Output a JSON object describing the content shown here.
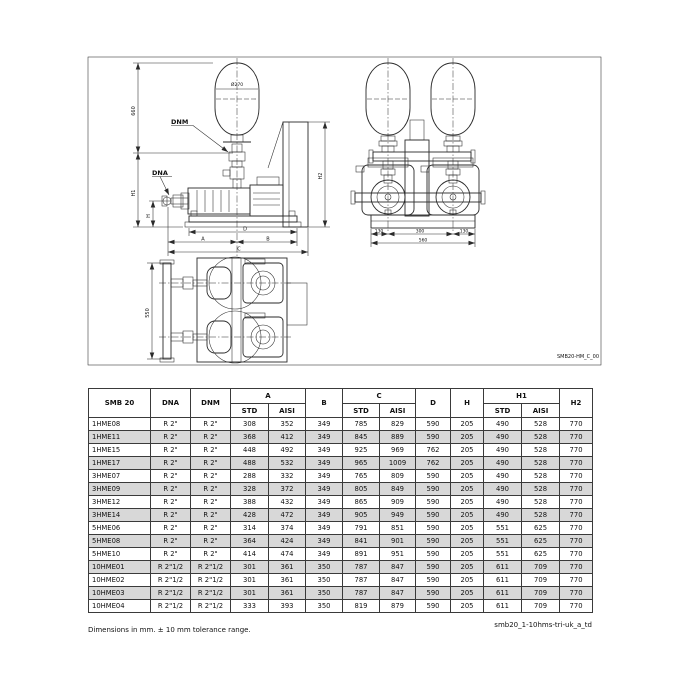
{
  "drawing": {
    "code": "SMB20-HM_C_00",
    "labels": {
      "dnm": "DNM",
      "dna": "DNA",
      "diam": "Ø270",
      "v660": "660",
      "h1": "H1",
      "h": "H",
      "h2": "H2",
      "d": "D",
      "a": "A",
      "b": "B",
      "c": "C",
      "f1": "130",
      "f2": "300",
      "f3": "130",
      "ftot": "560",
      "depth": "550"
    }
  },
  "table": {
    "headers": {
      "model": "SMB 20",
      "dna": "DNA",
      "dnm": "DNM",
      "a": "A",
      "b": "B",
      "c": "C",
      "d": "D",
      "h": "H",
      "h1": "H1",
      "h2": "H2",
      "std": "STD",
      "aisi": "AISI"
    },
    "rows": [
      {
        "m": "1HME08",
        "dna": "R 2\"",
        "dnm": "R 2\"",
        "a1": "308",
        "a2": "352",
        "b": "349",
        "c1": "785",
        "c2": "829",
        "d": "590",
        "h": "205",
        "h11": "490",
        "h12": "528",
        "h2": "770"
      },
      {
        "m": "1HME11",
        "dna": "R 2\"",
        "dnm": "R 2\"",
        "a1": "368",
        "a2": "412",
        "b": "349",
        "c1": "845",
        "c2": "889",
        "d": "590",
        "h": "205",
        "h11": "490",
        "h12": "528",
        "h2": "770"
      },
      {
        "m": "1HME15",
        "dna": "R 2\"",
        "dnm": "R 2\"",
        "a1": "448",
        "a2": "492",
        "b": "349",
        "c1": "925",
        "c2": "969",
        "d": "762",
        "h": "205",
        "h11": "490",
        "h12": "528",
        "h2": "770"
      },
      {
        "m": "1HME17",
        "dna": "R 2\"",
        "dnm": "R 2\"",
        "a1": "488",
        "a2": "532",
        "b": "349",
        "c1": "965",
        "c2": "1009",
        "d": "762",
        "h": "205",
        "h11": "490",
        "h12": "528",
        "h2": "770"
      },
      {
        "m": "3HME07",
        "dna": "R 2\"",
        "dnm": "R 2\"",
        "a1": "288",
        "a2": "332",
        "b": "349",
        "c1": "765",
        "c2": "809",
        "d": "590",
        "h": "205",
        "h11": "490",
        "h12": "528",
        "h2": "770"
      },
      {
        "m": "3HME09",
        "dna": "R 2\"",
        "dnm": "R 2\"",
        "a1": "328",
        "a2": "372",
        "b": "349",
        "c1": "805",
        "c2": "849",
        "d": "590",
        "h": "205",
        "h11": "490",
        "h12": "528",
        "h2": "770"
      },
      {
        "m": "3HME12",
        "dna": "R 2\"",
        "dnm": "R 2\"",
        "a1": "388",
        "a2": "432",
        "b": "349",
        "c1": "865",
        "c2": "909",
        "d": "590",
        "h": "205",
        "h11": "490",
        "h12": "528",
        "h2": "770"
      },
      {
        "m": "3HME14",
        "dna": "R 2\"",
        "dnm": "R 2\"",
        "a1": "428",
        "a2": "472",
        "b": "349",
        "c1": "905",
        "c2": "949",
        "d": "590",
        "h": "205",
        "h11": "490",
        "h12": "528",
        "h2": "770"
      },
      {
        "m": "5HME06",
        "dna": "R 2\"",
        "dnm": "R 2\"",
        "a1": "314",
        "a2": "374",
        "b": "349",
        "c1": "791",
        "c2": "851",
        "d": "590",
        "h": "205",
        "h11": "551",
        "h12": "625",
        "h2": "770"
      },
      {
        "m": "5HME08",
        "dna": "R 2\"",
        "dnm": "R 2\"",
        "a1": "364",
        "a2": "424",
        "b": "349",
        "c1": "841",
        "c2": "901",
        "d": "590",
        "h": "205",
        "h11": "551",
        "h12": "625",
        "h2": "770"
      },
      {
        "m": "5HME10",
        "dna": "R 2\"",
        "dnm": "R 2\"",
        "a1": "414",
        "a2": "474",
        "b": "349",
        "c1": "891",
        "c2": "951",
        "d": "590",
        "h": "205",
        "h11": "551",
        "h12": "625",
        "h2": "770"
      },
      {
        "m": "10HME01",
        "dna": "R 2\"1/2",
        "dnm": "R 2\"1/2",
        "a1": "301",
        "a2": "361",
        "b": "350",
        "c1": "787",
        "c2": "847",
        "d": "590",
        "h": "205",
        "h11": "611",
        "h12": "709",
        "h2": "770"
      },
      {
        "m": "10HME02",
        "dna": "R 2\"1/2",
        "dnm": "R 2\"1/2",
        "a1": "301",
        "a2": "361",
        "b": "350",
        "c1": "787",
        "c2": "847",
        "d": "590",
        "h": "205",
        "h11": "611",
        "h12": "709",
        "h2": "770"
      },
      {
        "m": "10HME03",
        "dna": "R 2\"1/2",
        "dnm": "R 2\"1/2",
        "a1": "301",
        "a2": "361",
        "b": "350",
        "c1": "787",
        "c2": "847",
        "d": "590",
        "h": "205",
        "h11": "611",
        "h12": "709",
        "h2": "770"
      },
      {
        "m": "10HME04",
        "dna": "R 2\"1/2",
        "dnm": "R 2\"1/2",
        "a1": "333",
        "a2": "393",
        "b": "350",
        "c1": "819",
        "c2": "879",
        "d": "590",
        "h": "205",
        "h11": "611",
        "h12": "709",
        "h2": "770"
      }
    ]
  },
  "footer": {
    "note": "Dimensions in mm. ± 10 mm tolerance range.",
    "doc_ref": "smb20_1-10hms-tri-uk_a_td"
  }
}
